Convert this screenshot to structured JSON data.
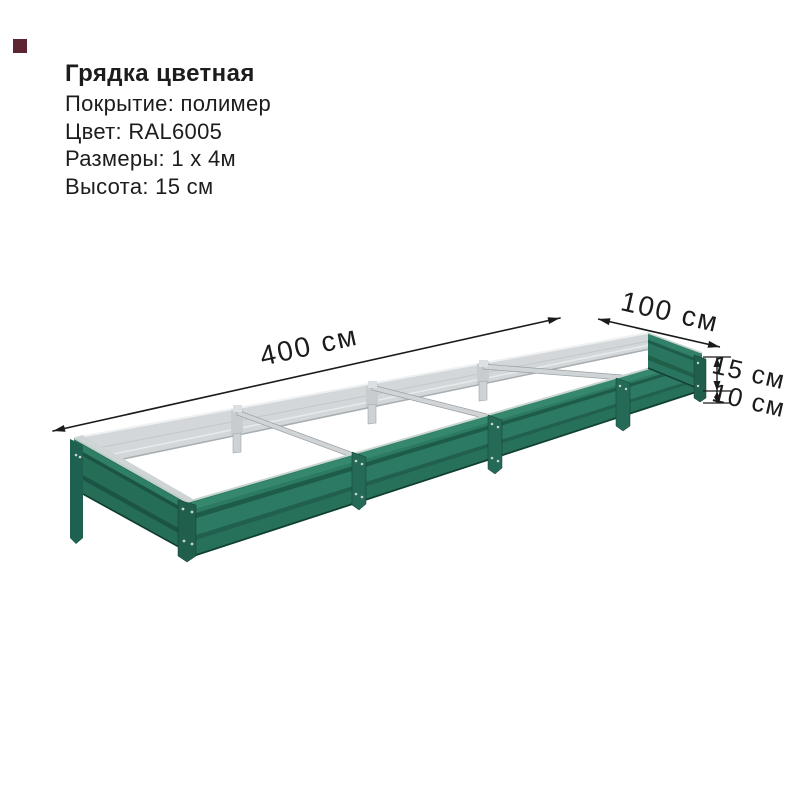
{
  "product": {
    "title": "Грядка цветная",
    "specs": [
      "Покрытие: полимер",
      "Цвет: RAL6005",
      "Размеры: 1 х 4м",
      "Высота: 15 см"
    ]
  },
  "dimensions": {
    "length": "400 см",
    "width": "100 см",
    "height": "15 см",
    "legs": "10 см"
  },
  "colors": {
    "bed_green": "#2c7a63",
    "bed_green_bright": "#35876d",
    "bed_green_dark": "#1e5c4a",
    "bed_green_leg": "#1f6150",
    "galvanized_silver": "#d3d7d9",
    "galvanized_light": "#eef0f1",
    "annotation_black": "#1b1b1b",
    "swatch_maroon": "#5c2531",
    "background": "#ffffff"
  }
}
